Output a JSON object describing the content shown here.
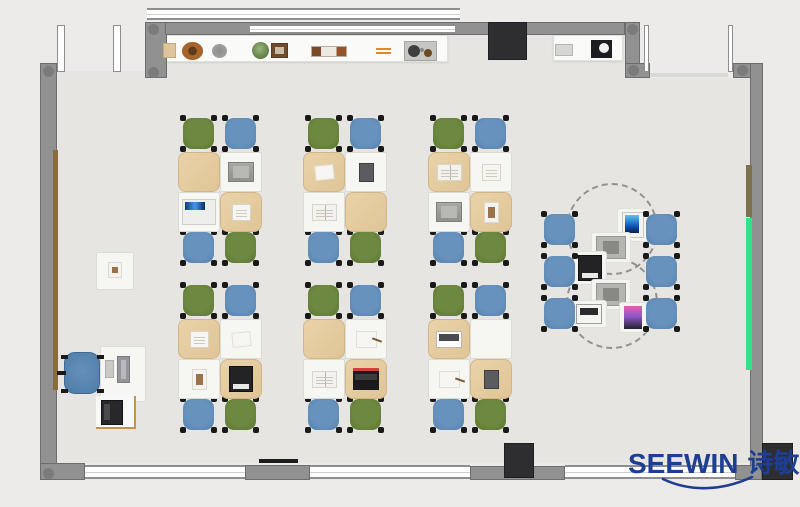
{
  "logo": {
    "latin": "SEEWIN",
    "cjk": "诗敏",
    "color": "#1d3e93"
  },
  "palette": {
    "background": "#ecebe9",
    "floor": "#e6e5e2",
    "wall": "#919191",
    "pillar": "#2e2e30",
    "chair_green": "#64803c",
    "chair_blue": "#5c88b4",
    "desk_white": "#f6f6f3",
    "desk_cover_tan": "#e6cfa3",
    "green_board": "#35e08a",
    "olive_board": "#7c734d",
    "wood_rail": "#8a6b40",
    "logo_blue": "#1d3e93"
  },
  "architecture": [
    {
      "name": "floor-main",
      "cls": "floor",
      "r": [
        57,
        78,
        693,
        385
      ]
    },
    {
      "name": "floor-entry-strip",
      "cls": "floor",
      "r": [
        167,
        35,
        458,
        43
      ]
    },
    {
      "name": "floor-door-gap",
      "cls": "floor",
      "r": [
        58,
        71,
        87,
        7
      ]
    },
    {
      "name": "display-counter-left",
      "cls": "shelf",
      "r": [
        162,
        35,
        286,
        27
      ]
    },
    {
      "name": "display-counter-right",
      "cls": "shelf",
      "r": [
        553,
        35,
        70,
        26
      ]
    },
    {
      "name": "wall-left",
      "cls": "wall",
      "r": [
        40,
        63,
        17,
        417
      ]
    },
    {
      "name": "wall-entry-column",
      "cls": "wall",
      "r": [
        145,
        22,
        22,
        56
      ]
    },
    {
      "name": "wall-top",
      "cls": "wall",
      "r": [
        165,
        22,
        460,
        13
      ]
    },
    {
      "name": "wall-top-right-vertical",
      "cls": "wall",
      "r": [
        625,
        22,
        15,
        45
      ]
    },
    {
      "name": "wall-top-right-stub",
      "cls": "wall",
      "r": [
        625,
        63,
        25,
        15
      ]
    },
    {
      "name": "wall-top-right-corner",
      "cls": "wall",
      "r": [
        733,
        63,
        30,
        15
      ]
    },
    {
      "name": "wall-right",
      "cls": "wall",
      "r": [
        750,
        63,
        13,
        417
      ]
    },
    {
      "name": "wall-bottom-left-corner",
      "cls": "wall",
      "r": [
        40,
        463,
        45,
        17
      ]
    },
    {
      "name": "wall-bottom-pier-1",
      "cls": "wall",
      "r": [
        245,
        465,
        65,
        15
      ]
    },
    {
      "name": "wall-bottom-pier-2",
      "cls": "wall",
      "r": [
        470,
        466,
        95,
        14
      ]
    },
    {
      "name": "wall-bottom-pier-3",
      "cls": "wall",
      "r": [
        735,
        465,
        27,
        15
      ]
    },
    {
      "name": "window-top-outer-band",
      "cls": "window-h",
      "r": [
        147,
        8,
        313,
        12
      ]
    },
    {
      "name": "window-top-wall-glazing",
      "cls": "window-h",
      "r": [
        250,
        24,
        205,
        10
      ]
    },
    {
      "name": "entry-door-leaf-1",
      "cls": "window-v",
      "r": [
        57,
        25,
        8,
        47
      ]
    },
    {
      "name": "entry-door-leaf-2",
      "cls": "window-v",
      "r": [
        113,
        25,
        8,
        47
      ]
    },
    {
      "name": "window-strip-1",
      "cls": "window-v",
      "r": [
        644,
        25,
        5,
        47
      ]
    },
    {
      "name": "window-strip-2",
      "cls": "window-v",
      "r": [
        728,
        25,
        5,
        47
      ]
    },
    {
      "name": "glass-partition-line",
      "cls": "glass-line",
      "r": [
        650,
        73,
        78,
        4
      ]
    },
    {
      "name": "window-bottom-1",
      "cls": "window-h",
      "r": [
        85,
        465,
        160,
        14
      ]
    },
    {
      "name": "window-bottom-2",
      "cls": "window-h",
      "r": [
        310,
        465,
        160,
        14
      ]
    },
    {
      "name": "window-bottom-3",
      "cls": "window-h",
      "r": [
        565,
        465,
        170,
        14
      ]
    },
    {
      "name": "pillar-top",
      "cls": "pillar",
      "r": [
        488,
        22,
        39,
        38
      ]
    },
    {
      "name": "pillar-bottom-middle",
      "cls": "pillar",
      "r": [
        504,
        443,
        30,
        35
      ]
    },
    {
      "name": "pillar-bottom-right",
      "cls": "pillar",
      "r": [
        762,
        443,
        31,
        37
      ]
    },
    {
      "name": "wall-board-olive",
      "cls": "board-olive",
      "r": [
        746,
        165,
        6,
        52
      ]
    },
    {
      "name": "wall-board-green",
      "cls": "board-green",
      "r": [
        746,
        218,
        6,
        152
      ]
    },
    {
      "name": "wood-rail-left",
      "cls": "wood-rail",
      "r": [
        53,
        150,
        5,
        240
      ]
    },
    {
      "name": "wall-mounted-bar",
      "cls": "dark-line",
      "r": [
        259,
        459,
        39,
        4
      ]
    }
  ],
  "wall_corner_dots": [
    [
      43,
      66
    ],
    [
      43,
      468
    ],
    [
      148,
      24
    ],
    [
      148,
      67
    ],
    [
      627,
      24
    ],
    [
      628,
      65
    ],
    [
      737,
      65
    ]
  ],
  "shelf_items": [
    {
      "name": "decor-box-tan",
      "type": "box-tan",
      "r": [
        163,
        43,
        13,
        15
      ]
    },
    {
      "name": "decor-basket",
      "type": "basket",
      "r": [
        182,
        42,
        21,
        18
      ]
    },
    {
      "name": "decor-plate",
      "type": "plate",
      "r": [
        212,
        44,
        15,
        14
      ]
    },
    {
      "name": "decor-plant",
      "type": "plant",
      "r": [
        252,
        42,
        17,
        17
      ]
    },
    {
      "name": "decor-photo-frame",
      "type": "frame",
      "r": [
        271,
        43,
        17,
        15
      ]
    },
    {
      "name": "decor-book-stack",
      "type": "books",
      "r": [
        311,
        46,
        36,
        11
      ]
    },
    {
      "name": "decor-pens",
      "type": "pens",
      "r": [
        376,
        48,
        15,
        6
      ]
    },
    {
      "name": "decor-tray",
      "type": "tray",
      "r": [
        404,
        41,
        33,
        20
      ]
    },
    {
      "name": "decor-box-gray",
      "type": "box-gray",
      "r": [
        555,
        44,
        18,
        12
      ]
    },
    {
      "name": "decor-appliance",
      "type": "appliance",
      "r": [
        591,
        40,
        21,
        18
      ]
    }
  ],
  "cluster_geometry": {
    "desk_w": 42,
    "desk_h": 40,
    "chair_size": 31,
    "chair_x": [
      5,
      47
    ],
    "desk_x": [
      0,
      42
    ],
    "chair_top_y": 0,
    "deskA_y": 34,
    "deskB_y": 74,
    "chair_bottom_y": 114
  },
  "clusters": [
    {
      "x": 178,
      "y": 118,
      "chairs_top": [
        "green",
        "blue"
      ],
      "chairs_bottom": [
        "blue",
        "green"
      ],
      "desks": [
        {
          "cover": "tan",
          "item": "none"
        },
        {
          "cover": "white",
          "item": "laptop-gray"
        },
        {
          "cover": "white",
          "item": "laptop-blue"
        },
        {
          "cover": "tan",
          "item": "notebook"
        }
      ]
    },
    {
      "x": 303,
      "y": 118,
      "chairs_top": [
        "green",
        "blue"
      ],
      "chairs_bottom": [
        "blue",
        "green"
      ],
      "desks": [
        {
          "cover": "tan",
          "item": "paper"
        },
        {
          "cover": "white",
          "item": "tablet-dark"
        },
        {
          "cover": "white",
          "item": "book"
        },
        {
          "cover": "tan",
          "item": "none"
        }
      ]
    },
    {
      "x": 428,
      "y": 118,
      "chairs_top": [
        "green",
        "blue"
      ],
      "chairs_bottom": [
        "blue",
        "green"
      ],
      "desks": [
        {
          "cover": "tan",
          "item": "book"
        },
        {
          "cover": "white",
          "item": "notebook"
        },
        {
          "cover": "white",
          "item": "laptop-gray"
        },
        {
          "cover": "tan",
          "item": "photo"
        }
      ]
    },
    {
      "x": 178,
      "y": 285,
      "chairs_top": [
        "green",
        "blue"
      ],
      "chairs_bottom": [
        "blue",
        "green"
      ],
      "desks": [
        {
          "cover": "tan",
          "item": "notebook"
        },
        {
          "cover": "white",
          "item": "paper"
        },
        {
          "cover": "white",
          "item": "photo"
        },
        {
          "cover": "tan",
          "item": "laptop-black"
        }
      ]
    },
    {
      "x": 303,
      "y": 285,
      "chairs_top": [
        "green",
        "blue"
      ],
      "chairs_bottom": [
        "blue",
        "green"
      ],
      "desks": [
        {
          "cover": "tan",
          "item": "none"
        },
        {
          "cover": "white",
          "item": "paper-pen"
        },
        {
          "cover": "white",
          "item": "book"
        },
        {
          "cover": "tan",
          "item": "laptop-red"
        }
      ]
    },
    {
      "x": 428,
      "y": 285,
      "chairs_top": [
        "green",
        "blue"
      ],
      "chairs_bottom": [
        "blue",
        "green"
      ],
      "desks": [
        {
          "cover": "tan",
          "item": "device-white"
        },
        {
          "cover": "white",
          "item": "none"
        },
        {
          "cover": "white",
          "item": "paper-pen"
        },
        {
          "cover": "tan",
          "item": "tablet-dark"
        }
      ]
    }
  ],
  "collab_area": {
    "dashed_tables": [
      [
        566,
        183,
        92
      ],
      [
        566,
        257,
        92
      ]
    ],
    "chairs": [
      [
        544,
        214
      ],
      [
        646,
        214
      ],
      [
        544,
        256
      ],
      [
        646,
        256
      ],
      [
        544,
        298
      ],
      [
        646,
        298
      ]
    ],
    "chair_color": "blue",
    "devices": [
      {
        "x": 622,
        "y": 212,
        "type": "tablet-blue"
      },
      {
        "x": 596,
        "y": 236,
        "type": "device-gray"
      },
      {
        "x": 578,
        "y": 255,
        "type": "laptop-black"
      },
      {
        "x": 596,
        "y": 283,
        "type": "device-gray"
      },
      {
        "x": 576,
        "y": 304,
        "type": "laptop-white"
      },
      {
        "x": 624,
        "y": 306,
        "type": "tablet-colorful"
      }
    ]
  },
  "teacher_station": {
    "side_table": [
      96,
      252,
      38,
      38
    ],
    "side_table_item": {
      "type": "photo",
      "r": [
        108,
        262,
        14,
        16
      ]
    },
    "office_chair": [
      64,
      352,
      36,
      42
    ],
    "desk": [
      100,
      346,
      46,
      56
    ],
    "keyboard": [
      105,
      360,
      9,
      18
    ],
    "monitor": [
      117,
      356,
      13,
      27
    ],
    "printer_table": [
      96,
      396,
      40,
      33
    ],
    "printer": [
      101,
      400,
      22,
      25
    ]
  }
}
